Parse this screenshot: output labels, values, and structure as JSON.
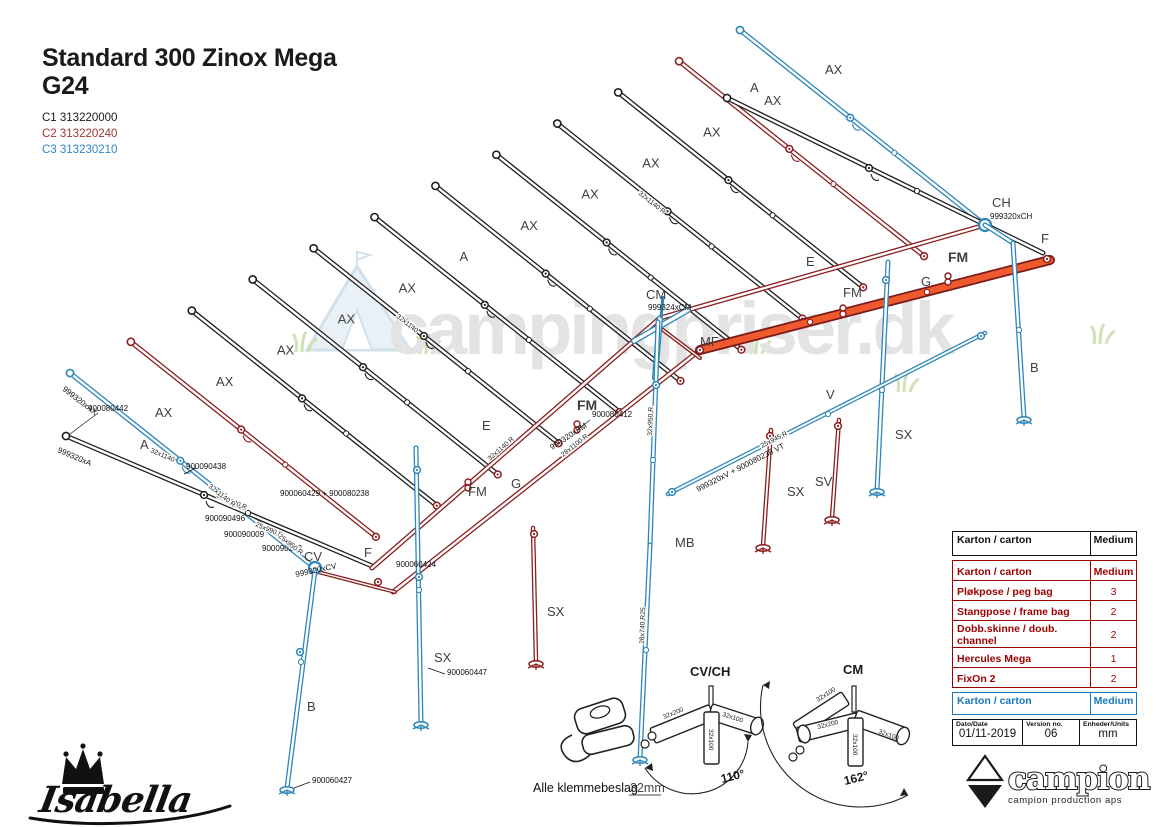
{
  "title": {
    "line1": "Standard 300 Zinox Mega",
    "line2": "G24"
  },
  "codes": {
    "c1": "C1 313220000",
    "c2": "C2 313220240",
    "c3": "C3 313230210"
  },
  "watermark": {
    "text": "campingpriser.dk"
  },
  "labels": {
    "a": "A",
    "ax": "AX",
    "b": "B",
    "e": "E",
    "f": "F",
    "g": "G",
    "v": "V",
    "ch": "CH",
    "cm": "CM",
    "cv": "CV",
    "fm": "FM",
    "mf": "MF",
    "mb": "MB",
    "sx": "SX",
    "sv": "SV",
    "ch_part": "999320xCH",
    "cm_part": "999324xCM",
    "cv_part": "999320xCV",
    "ax_part": "999320xAX",
    "a_part": "999320xA",
    "fm_part": "999320xFM"
  },
  "parts": {
    "p1": "900080442",
    "p2": "900090438",
    "p3": "900090496",
    "p4": "900090009",
    "p5": "900090243",
    "p6": "900060424",
    "p7": "900060427",
    "p8": "900060447",
    "p9": "900080412",
    "p10": "900060429 + 900080238",
    "p11": "999320xV + 900080238 VT"
  },
  "dims": {
    "d1": "32x1140",
    "d2": "32x1140 R",
    "d3": "25x950 R",
    "d4": "28x1100 R",
    "d5": "32x950 R",
    "d7": "28x740 R25",
    "d8": "25x945 R",
    "d9": "25x990 R"
  },
  "details": {
    "clamp_note": "Alle klemmebeslag",
    "clamp_size": "32mm",
    "cvch": {
      "label": "CV/CH",
      "angle": "110°",
      "pipe_left": "32x200",
      "pipe_right": "32x100",
      "pipe_down": "32x100"
    },
    "cm": {
      "label": "CM",
      "angle": "162°",
      "pipe_upleft": "32x100",
      "pipe_left": "32x200",
      "pipe_right": "32x100",
      "pipe_down": "32x100"
    }
  },
  "tables": {
    "karton_black": {
      "label": "Karton / carton",
      "value": "Medium"
    },
    "karton_red": {
      "header": {
        "label": "Karton / carton",
        "value": "Medium"
      },
      "rows": [
        {
          "label": "Pløkpose / peg bag",
          "qty": "3"
        },
        {
          "label": "Stangpose / frame bag",
          "qty": "2"
        },
        {
          "label": "Dobb.skinne / doub. channel",
          "qty": "2"
        },
        {
          "label": "Hercules Mega",
          "qty": "1"
        },
        {
          "label": "FixOn 2",
          "qty": "2"
        }
      ]
    },
    "karton_blue": {
      "label": "Karton / carton",
      "value": "Medium"
    },
    "info": {
      "date_label": "Dato/Date",
      "date_value": "01/11-2019",
      "version_label": "Version no.",
      "version_value": "06",
      "units_label": "Enheder/Units",
      "units_value": "mm"
    }
  },
  "logos": {
    "isabella": "Isabella",
    "campion": "campion",
    "campion_sub": "campion production aps"
  },
  "colors": {
    "pole_black": "#1f1f1f",
    "pole_red": "#8b1f1f",
    "pole_blue": "#2e86b8",
    "orange": "#ee5a2d",
    "table_red": "#9b0000",
    "table_blue": "#1878be"
  }
}
